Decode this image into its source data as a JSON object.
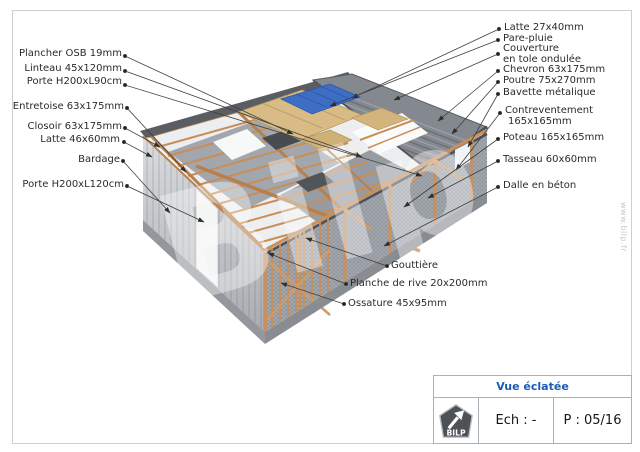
{
  "watermark": {
    "big_text": "Bilp",
    "side_text": "www.bilp.fr"
  },
  "diagram": {
    "labels_left": [
      {
        "text": "Plancher OSB 19mm"
      },
      {
        "text": "Linteau 45x120mm"
      },
      {
        "text": "Porte H200xL90cm"
      },
      {
        "text": "Entretoise 63x175mm"
      },
      {
        "text": "Closoir 63x175mm"
      },
      {
        "text": "Latte 46x60mm"
      },
      {
        "text": "Bardage"
      },
      {
        "text": "Porte H200xL120cm"
      }
    ],
    "labels_right": [
      {
        "text": "Latte 27x40mm"
      },
      {
        "text": "Pare-pluie"
      },
      {
        "text": "Couverture",
        "text2": "en tole ondulée"
      },
      {
        "text": "Chevron 63x175mm"
      },
      {
        "text": "Poutre 75x270mm"
      },
      {
        "text": "Bavette métalique"
      },
      {
        "text": "Contreventement",
        "text2": "165x165mm"
      },
      {
        "text": "Poteau 165x165mm"
      },
      {
        "text": "Tasseau 60x60mm"
      },
      {
        "text": "Dalle en béton"
      }
    ],
    "labels_bottom": [
      {
        "text": "Gouttière"
      },
      {
        "text": "Planche de rive 20x200mm"
      },
      {
        "text": "Ossature 45x95mm"
      }
    ],
    "colors": {
      "wood": "#c98e57",
      "roof_gray": "#84888f",
      "osb_tan": "#d9bc85",
      "tarp_blue": "#3e6ec3",
      "wall_gray": "#cdd0d3",
      "slab_gray": "#94989d"
    }
  },
  "title_block": {
    "title": "Vue éclatée",
    "logo_text": "BILP",
    "scale_label": "Ech : -",
    "page_label": "P : 05/16"
  }
}
